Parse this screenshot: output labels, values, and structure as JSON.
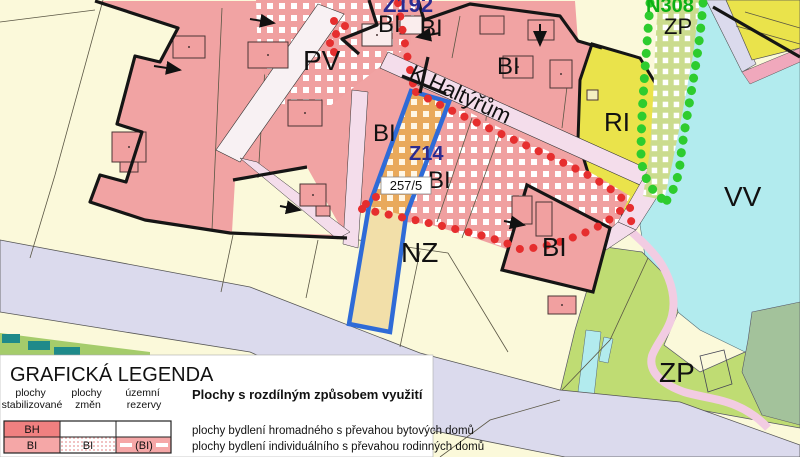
{
  "map": {
    "zone_labels": {
      "z192": "Z192",
      "bi": "BI",
      "pv": "PV",
      "street_name": "K Haltýřům",
      "n308": "N308",
      "zp": "ZP",
      "ri": "RI",
      "vv": "VV",
      "z14": "Z14",
      "nz": "NZ",
      "parcel_number": "257/5"
    },
    "colors": {
      "residential_pink": "#F1A3A3",
      "checker_red": "#F0A0A0",
      "recreation_yellow": "#EAE34B",
      "water_cyan": "#B2EBEE",
      "greenery_green": "#BFDC73",
      "base_parcel": "#FBF9DA",
      "road_lavender": "#DBDAED",
      "highlight_blue": "#2F6BD7",
      "boundary_red_dots": "#E62E2E",
      "boundary_green_dots": "#2ECC2E"
    }
  },
  "legend": {
    "title": "GRAFICKÁ LEGENDA",
    "columns": [
      {
        "line1": "plochy",
        "line2": "stabilizované"
      },
      {
        "line1": "plochy",
        "line2": "změn"
      },
      {
        "line1": "územní",
        "line2": "rezervy"
      }
    ],
    "section_title": "Plochy s rozdílným způsobem využití",
    "rows": [
      {
        "code": "BH",
        "change": "",
        "reserve": "",
        "description": "plochy bydlení hromadného s převahou bytových domů"
      },
      {
        "code": "BI",
        "change": "BI",
        "reserve": "(BI)",
        "description": "plochy bydlení individuálního s převahou rodinných domů"
      }
    ]
  }
}
